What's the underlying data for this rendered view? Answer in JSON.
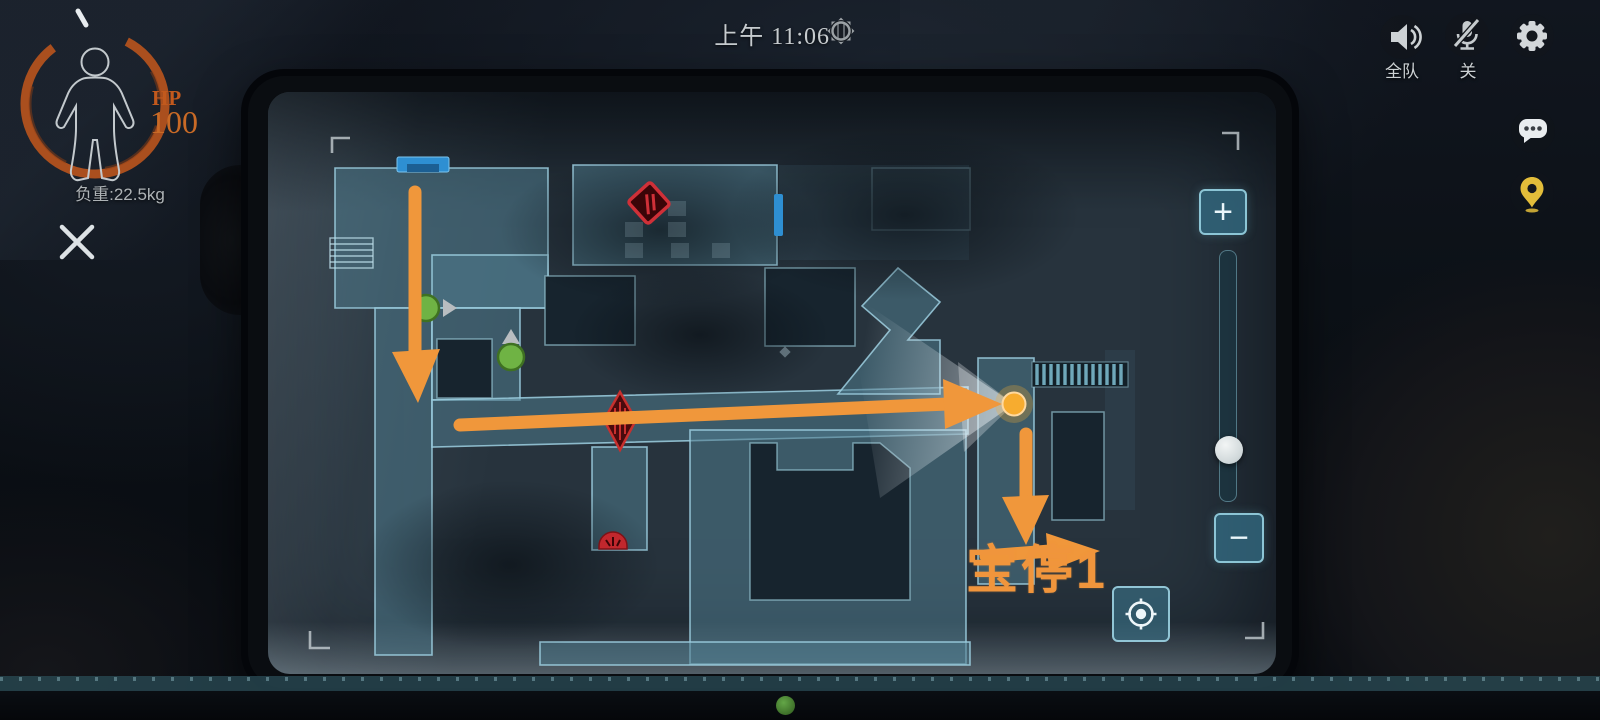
{
  "hud": {
    "time": "上午 11:06",
    "hp_label": "HP",
    "hp_value": "100",
    "weight": "负重:22.5kg",
    "voice_channel": "全队",
    "mic_state": "关"
  },
  "map_overlay": {
    "annotation": "宝停1",
    "zoom_in_label": "+",
    "zoom_out_label": "−",
    "marker_counts": {
      "teammate_green_dots": 2,
      "danger_red_icons": 3,
      "objective_yellow_dot": 1,
      "route_arrows": 4,
      "blue_doors": 2
    }
  },
  "colors": {
    "accent_orange": "#F0953C",
    "hp_orange": "#C2591D",
    "map_teal_fill": "#4E7A8C",
    "map_teal_stroke": "#9CCFE0",
    "treasure_yellow": "#F7AC2F",
    "player_green": "#6FB344",
    "danger_red": "#C1272D",
    "door_blue": "#2E8FD2",
    "pin_yellow": "#E3BD3A"
  }
}
